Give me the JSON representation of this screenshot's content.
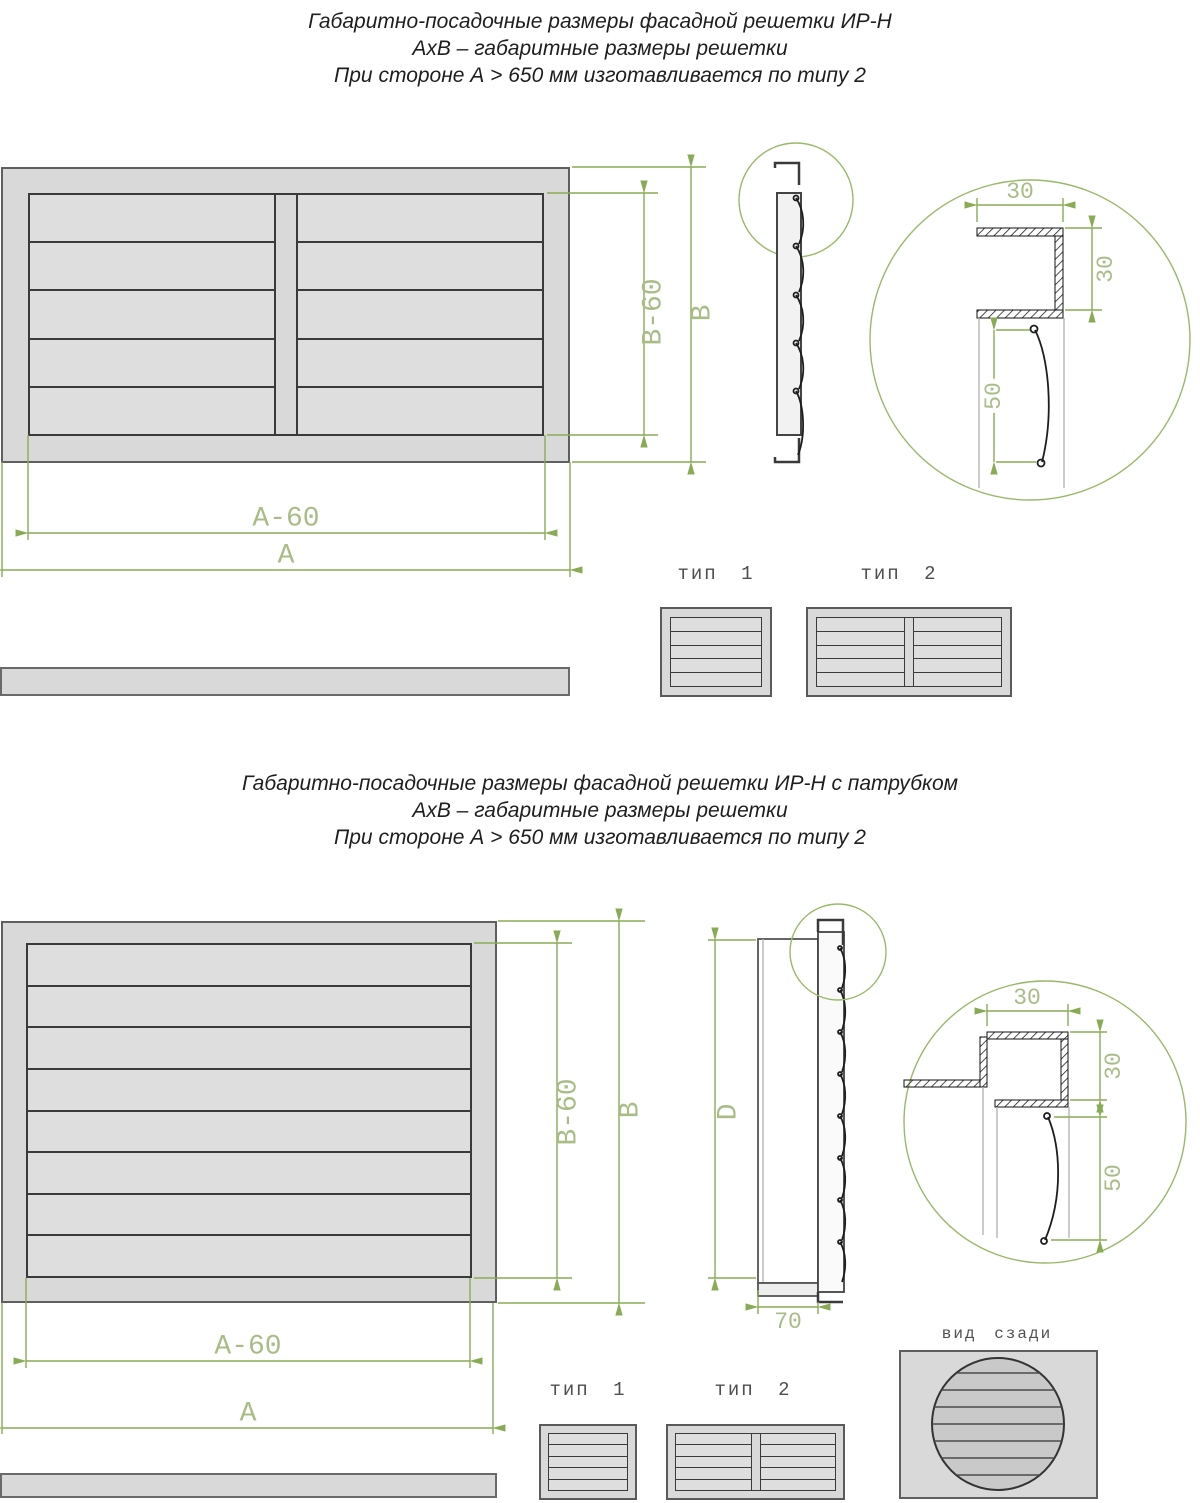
{
  "section1": {
    "title": {
      "line1": "Габаритно-посадочные размеры фасадной решетки ИР-Н",
      "line2": "АхВ – габаритные размеры решетки",
      "line3": "При стороне А > 650 мм изготавливается по типу 2"
    },
    "front": {
      "dim_b60": "B-60",
      "dim_b": "B",
      "dim_a60": "A-60",
      "dim_a": "A"
    },
    "detail": {
      "dim_width": "30",
      "dim_height": "30",
      "dim_blade": "50"
    },
    "types": {
      "type1_label": "тип 1",
      "type2_label": "тип 2"
    }
  },
  "section2": {
    "title": {
      "line1": "Габаритно-посадочные размеры фасадной решетки ИР-Н с патрубком",
      "line2": "АхВ – габаритные размеры решетки",
      "line3": "При стороне А > 650 мм изготавливается по типу 2"
    },
    "front": {
      "dim_b60": "B-60",
      "dim_b": "B",
      "dim_a60": "A-60",
      "dim_a": "A"
    },
    "side": {
      "dim_d": "D",
      "dim_depth": "70"
    },
    "detail": {
      "dim_width": "30",
      "dim_height": "30",
      "dim_blade": "50"
    },
    "types": {
      "type1_label": "тип 1",
      "type2_label": "тип 2"
    },
    "rear": {
      "label": "вид сзади"
    }
  }
}
